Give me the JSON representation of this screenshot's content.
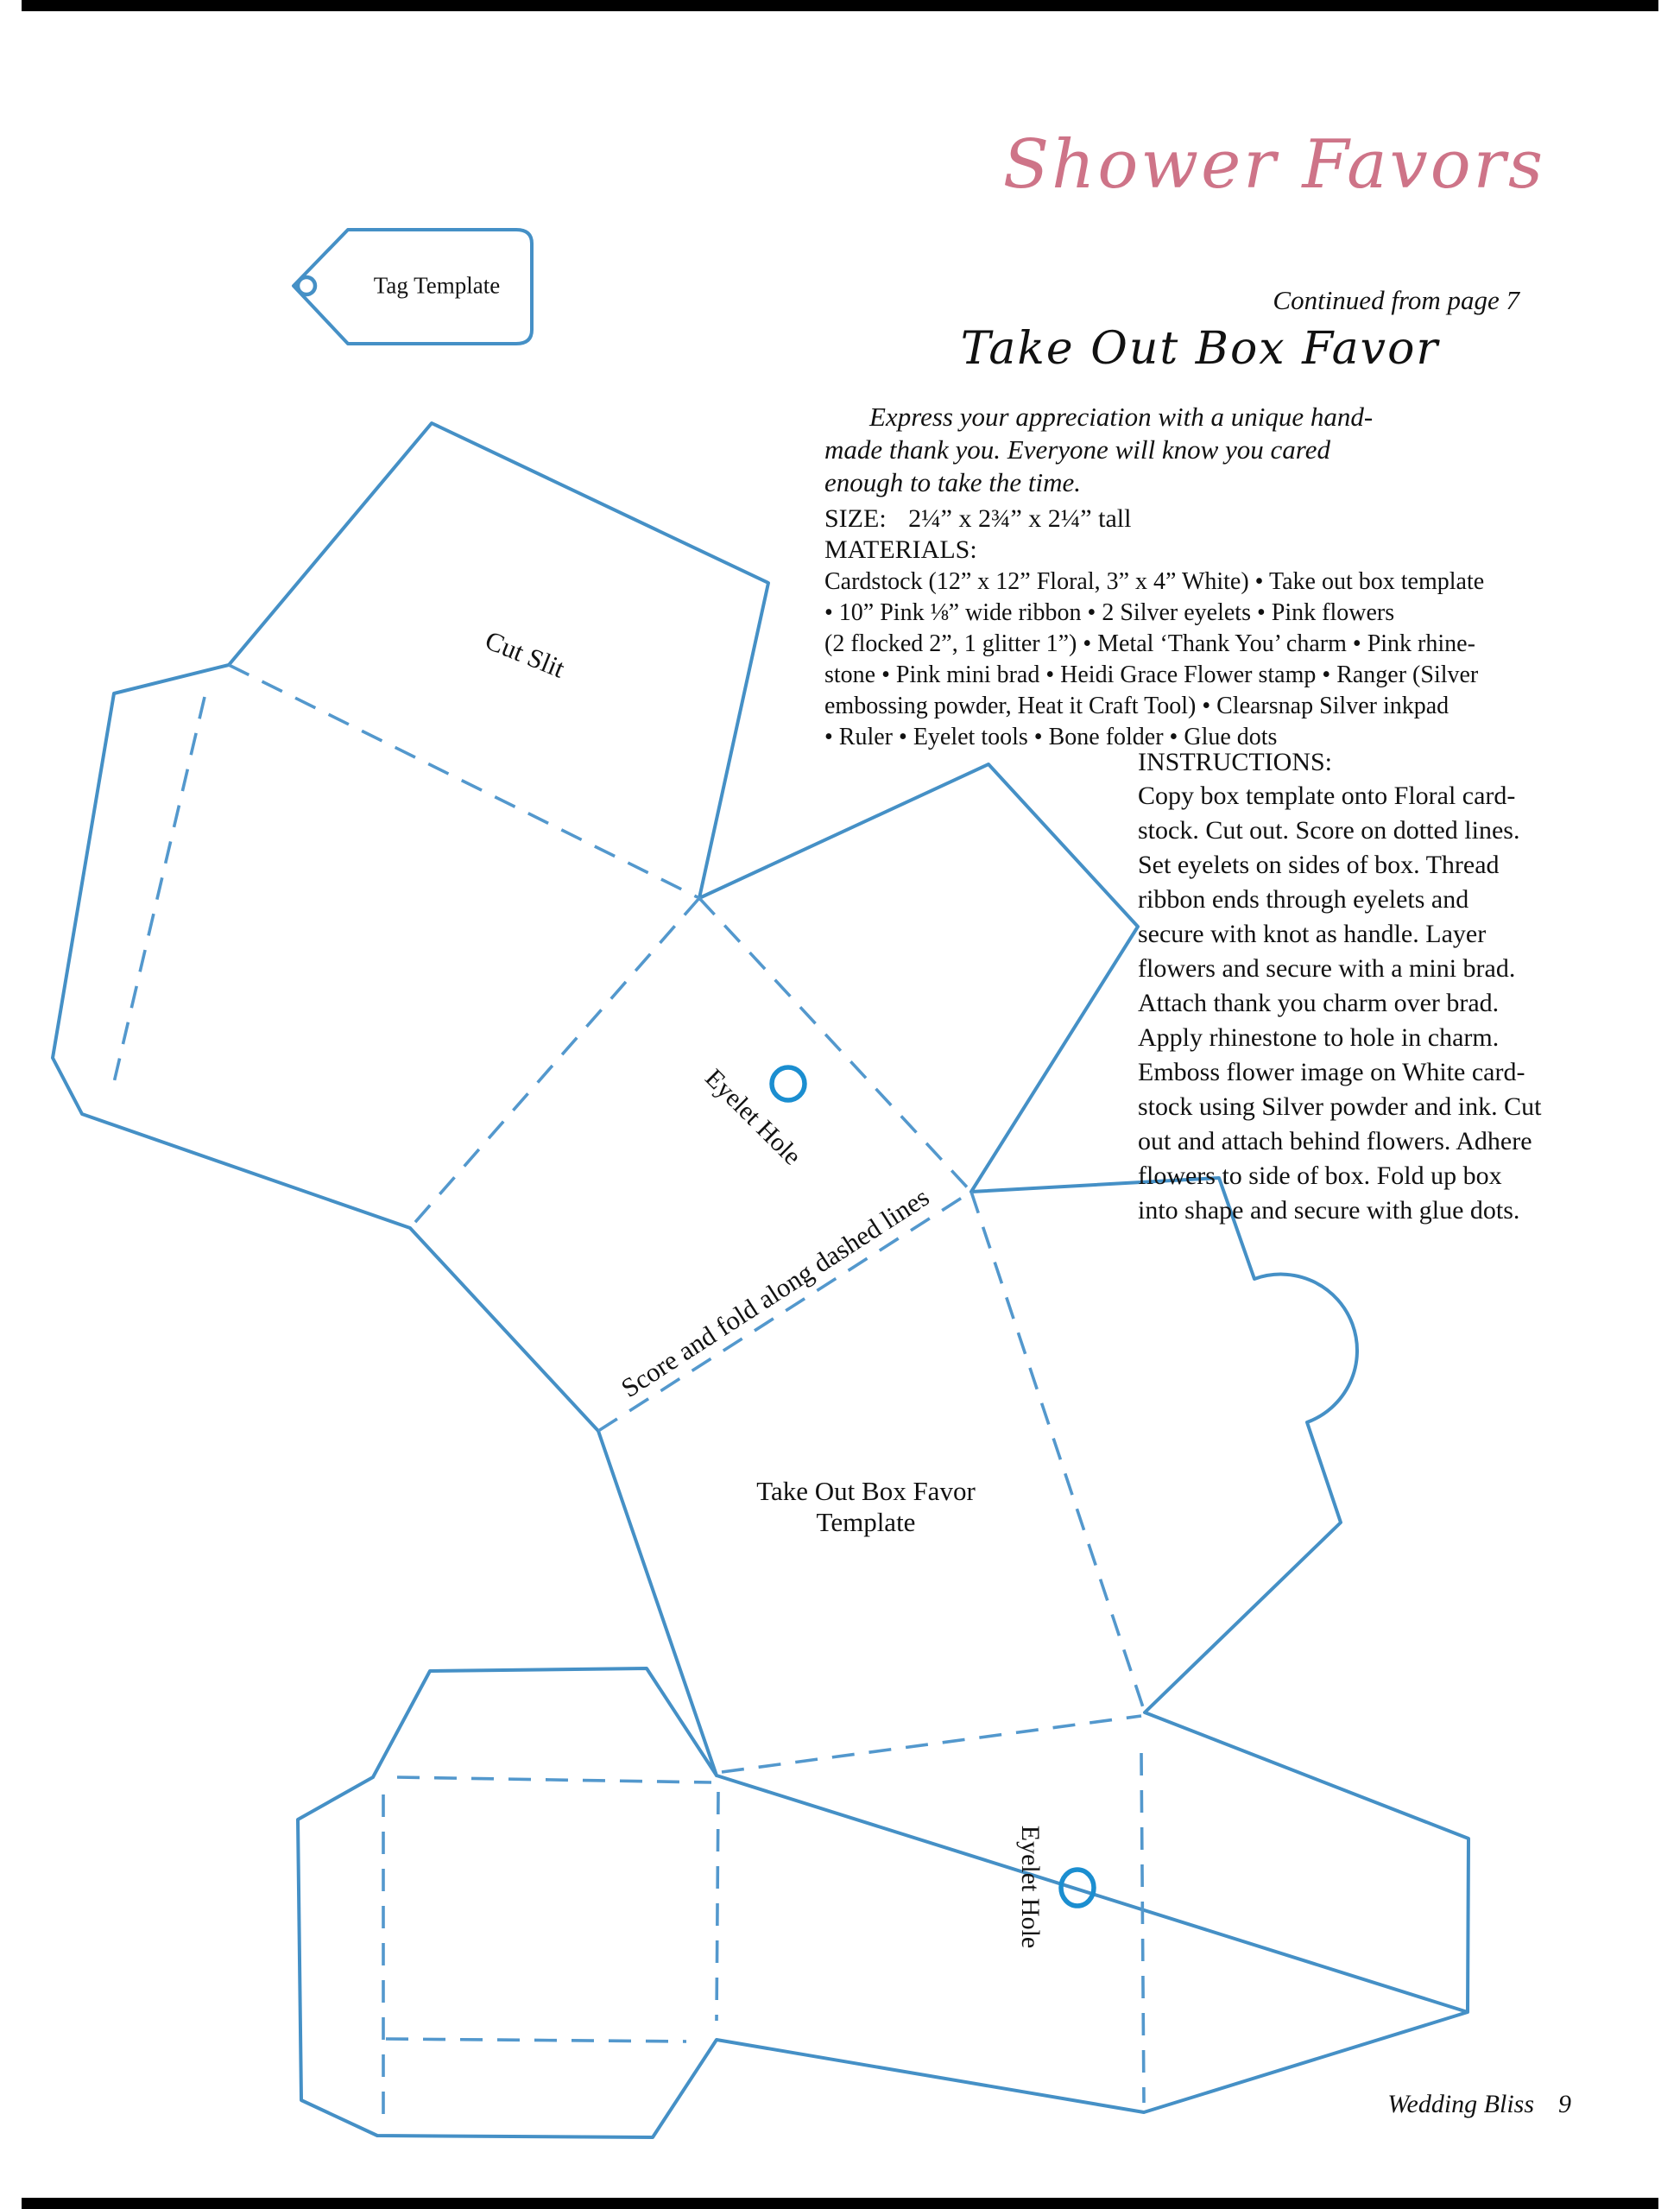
{
  "page": {
    "header_title": "Shower Favors",
    "continued": "Continued from page 7",
    "footer_title": "Wedding Bliss",
    "footer_page": "9"
  },
  "article": {
    "title": "Take Out Box Favor",
    "intro_lines": [
      "Express your appreciation with a unique hand-",
      "made thank you. Everyone will know you cared",
      "enough to take the time."
    ],
    "size_label": "SIZE:",
    "size_value": "2¼” x 2¾” x 2¼” tall",
    "materials_label": "MATERIALS:",
    "materials_lines": [
      "Cardstock (12” x 12” Floral, 3” x 4” White) • Take out box template",
      "• 10” Pink ⅛” wide ribbon • 2 Silver eyelets • Pink flowers",
      "(2 flocked 2”, 1 glitter 1”) • Metal ‘Thank You’ charm • Pink rhine-",
      "stone • Pink mini brad • Heidi Grace Flower stamp • Ranger (Silver",
      "embossing powder, Heat it Craft Tool) • Clearsnap Silver inkpad",
      "• Ruler • Eyelet tools • Bone folder • Glue dots"
    ],
    "instructions_label": "INSTRUCTIONS:",
    "instructions_lines": [
      "Copy box template onto Floral card-",
      "stock. Cut out. Score on dotted lines.",
      "Set eyelets on sides of box. Thread",
      "ribbon ends through eyelets and",
      "secure with knot as handle. Layer",
      "flowers and secure with a mini brad.",
      "Attach thank you charm over brad.",
      "Apply rhinestone to hole in charm.",
      "Emboss flower image on White card-",
      "stock using Silver powder and ink. Cut",
      "out and attach behind flowers. Adhere",
      "flowers to side of box. Fold up box",
      "into shape and secure with glue dots."
    ]
  },
  "diagram": {
    "labels": {
      "tag_template": "Tag Template",
      "cut_slit": "Cut Slit",
      "eyelet_hole_mid": "Eyelet Hole",
      "score_fold": "Score and fold along dashed lines",
      "template_line1": "Take Out Box Favor",
      "template_line2": "Template",
      "eyelet_hole_bottom": "Eyelet Hole"
    },
    "colors": {
      "line_blue": "#4590c6",
      "dashed_blue": "#5398cd",
      "eyelet_blue": "#1b8ed0",
      "title_pink": "#ce7488"
    }
  }
}
